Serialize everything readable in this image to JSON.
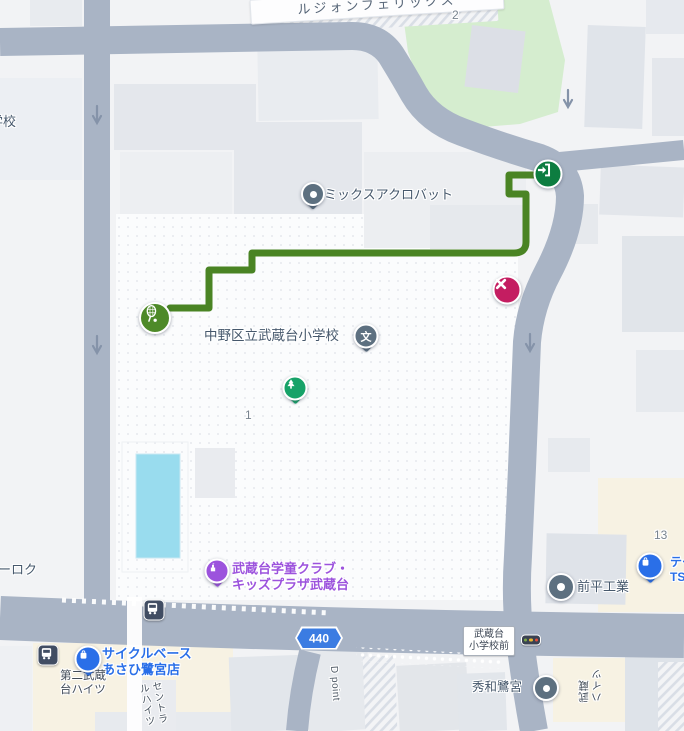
{
  "app": {
    "type": "map-view",
    "region": "武蔵台 (Musashidai), Nakano"
  },
  "colors": {
    "route_green": "#4a8424",
    "entrance_green": "#0d7d40",
    "sports_green": "#4e8a28",
    "park_green": "#d5edcf",
    "tree_green": "#17a268",
    "destination_red": "#c41d61",
    "road_gray": "#a9b4c5",
    "store_blue": "#2a6fe8",
    "poi_purple": "#9c53dd",
    "pin_slate": "#5d7080",
    "pool_blue": "#99dcee",
    "shield_blue": "#3b7ce2",
    "bus_dark": "#414d63",
    "parcel_beige": "#f7f2e3"
  },
  "labels": {
    "building_felix": "ルジォンフェリックス",
    "parcel_2": "2",
    "school_partial": "学校",
    "mix_acrobat": "ミックスアクロバット",
    "elementary": "中野区立武蔵台小学校",
    "parcel_1": "1",
    "kids_club": "武蔵台学童クラブ・\nキッズプラザ武蔵台",
    "rock_partial": "ーロク",
    "shield": "440",
    "bus_stop": "武蔵台\n小学校前",
    "cycle_store": "サイクルベース\nあさひ鷺宮店",
    "heights2": "第二武蔵\n台ハイツ",
    "central_heights": "セントラ\nルハイツ",
    "d_point": "D point",
    "maehira": "前平工業",
    "parcel_13": "13",
    "tailor": "テー\nTS&",
    "shuwa": "秀和鷺宮",
    "musashi_heights": "武蔵\nハイツ"
  },
  "icons": {
    "school_glyph": "文",
    "entrance": "login-arrow-into-door",
    "sports": "tennis-racket",
    "park": "pine-tree",
    "destination": "x-cross",
    "store": "shopping-bag",
    "kids_club": "building",
    "bus": "bus-front",
    "poi_dot": "dot",
    "traffic_light": "signal-3-dots",
    "one_way": "down-arrow"
  }
}
